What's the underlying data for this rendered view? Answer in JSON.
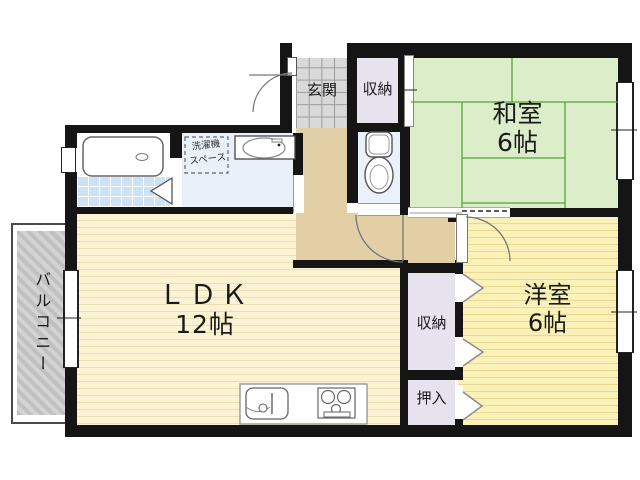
{
  "title": "apartment floor plan",
  "rooms": {
    "washitsu": {
      "name": "和室",
      "size": "6帖"
    },
    "yoshitsu": {
      "name": "洋室",
      "size": "6帖"
    },
    "ldk": {
      "name": "ＬＤＫ",
      "size": "12帖"
    },
    "genkan": {
      "label": "玄関"
    },
    "storage_top": {
      "label": "収納"
    },
    "storage_mid": {
      "label": "収納"
    },
    "oshiire": {
      "label": "押入"
    },
    "balcony": {
      "label": "バルコニー"
    },
    "laundry": {
      "line1": "洗濯機",
      "line2": "スペース"
    }
  },
  "fixtures": {
    "bathtub": "bathtub",
    "toilet": "toilet",
    "vanity_sink": "vanity-sink",
    "kitchen_sink": "kitchen-sink",
    "stove": "stove"
  },
  "colors": {
    "wall": "#151515",
    "tatami_green": "#dcedca",
    "tatami_line": "#55a33a",
    "ldk_floor": "#fbf3d3",
    "yoshitsu_floor": "#faf1b8",
    "corridor": "#e2cfa6",
    "closet": "#e7e3ee",
    "wet_floor": "#e9f0f9",
    "bath_tile": "#cde2f4",
    "balcony_gray": "#c9c9c9"
  }
}
